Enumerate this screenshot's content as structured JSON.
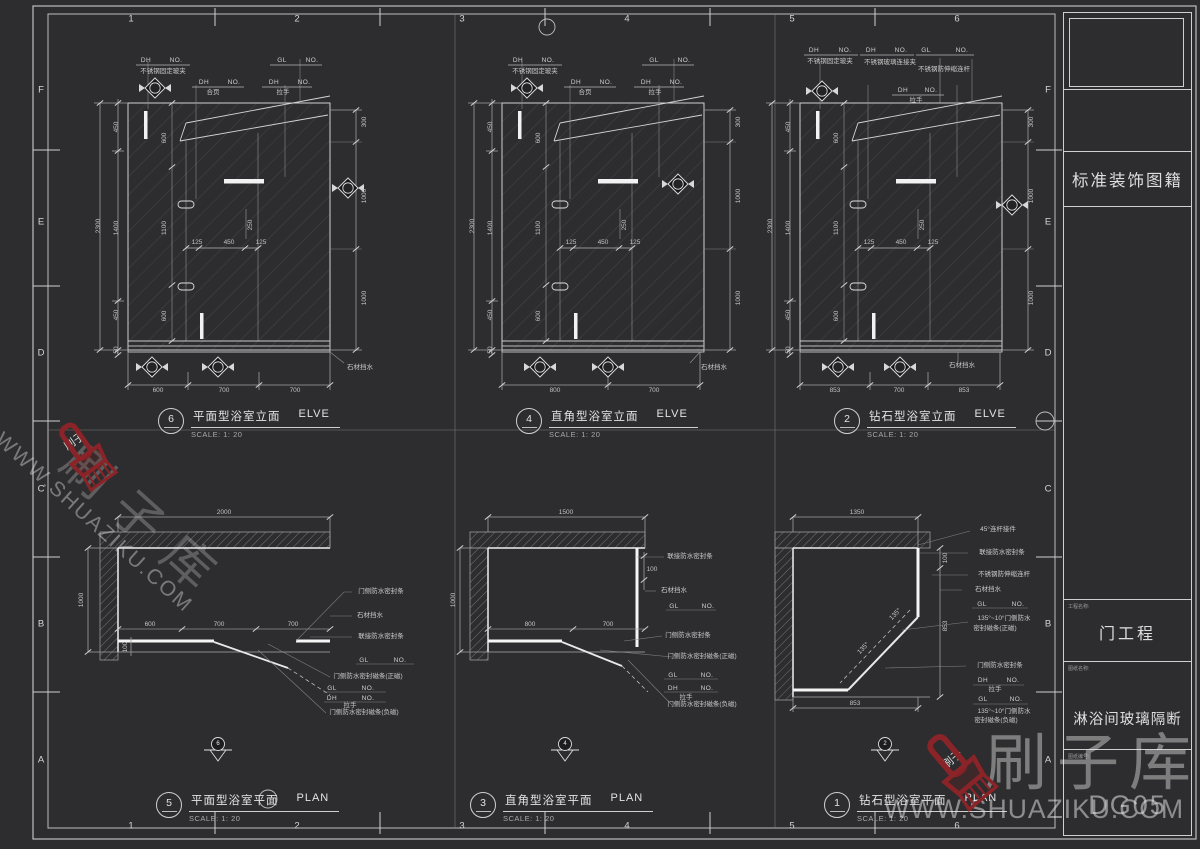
{
  "accent_red": "#8A2428",
  "line_color": "#C9C9C9",
  "grid": {
    "top_numbers": [
      "1",
      "2",
      "3",
      "4",
      "5",
      "6"
    ],
    "bottom_numbers": [
      "1",
      "2",
      "3",
      "4",
      "5",
      "6"
    ],
    "left_letters": [
      "F",
      "E",
      "D",
      "C",
      "B",
      "A"
    ],
    "right_letters": [
      "F",
      "E",
      "D",
      "C",
      "B",
      "A"
    ]
  },
  "title_block": {
    "series_title": "标准装饰图籍",
    "project_label": "工程名称:",
    "project_name": "门工程",
    "drawing_label": "图纸名称:",
    "drawing_name": "淋浴间玻璃隔断",
    "number_label": "图纸编号:",
    "drawing_number": "DG05"
  },
  "watermark": {
    "brand": "刷子库",
    "url": "WWW.SHUAZIKU.COM",
    "logo_text": "刷子"
  },
  "drawings": [
    {
      "no": "6",
      "name": "平面型浴室立面",
      "kind": "ELVE",
      "scale": "SCALE: 1: 20"
    },
    {
      "no": "4",
      "name": "直角型浴室立面",
      "kind": "ELVE",
      "scale": "SCALE: 1: 20"
    },
    {
      "no": "2",
      "name": "钻石型浴室立面",
      "kind": "ELVE",
      "scale": "SCALE: 1: 20"
    },
    {
      "no": "5",
      "name": "平面型浴室平面",
      "kind": "PLAN",
      "scale": "SCALE: 1: 20"
    },
    {
      "no": "3",
      "name": "直角型浴室平面",
      "kind": "PLAN",
      "scale": "SCALE: 1: 20"
    },
    {
      "no": "1",
      "name": "钻石型浴室平面",
      "kind": "PLAN",
      "scale": "SCALE: 1: 20"
    }
  ],
  "labels": [
    [
      "1",
      131,
      19,
      0,
      "g"
    ],
    [
      "2",
      297,
      19,
      0,
      "g"
    ],
    [
      "3",
      462,
      19,
      0,
      "g"
    ],
    [
      "4",
      627,
      19,
      0,
      "g"
    ],
    [
      "5",
      792,
      19,
      0,
      "g"
    ],
    [
      "6",
      957,
      19,
      0,
      "g"
    ],
    [
      "1",
      131,
      826,
      0,
      "g"
    ],
    [
      "2",
      297,
      826,
      0,
      "g"
    ],
    [
      "3",
      462,
      826,
      0,
      "g"
    ],
    [
      "4",
      627,
      826,
      0,
      "g"
    ],
    [
      "5",
      792,
      826,
      0,
      "g"
    ],
    [
      "6",
      957,
      826,
      0,
      "g"
    ],
    [
      "F",
      41,
      90,
      0,
      "g"
    ],
    [
      "E",
      41,
      222,
      0,
      "g"
    ],
    [
      "D",
      41,
      353,
      0,
      "g"
    ],
    [
      "C",
      41,
      489,
      0,
      "g"
    ],
    [
      "B",
      41,
      624,
      0,
      "g"
    ],
    [
      "A",
      41,
      760,
      0,
      "g"
    ],
    [
      "F",
      1048,
      90,
      0,
      "g"
    ],
    [
      "E",
      1048,
      222,
      0,
      "g"
    ],
    [
      "D",
      1048,
      353,
      0,
      "g"
    ],
    [
      "C",
      1048,
      489,
      0,
      "g"
    ],
    [
      "B",
      1048,
      624,
      0,
      "g"
    ],
    [
      "A",
      1048,
      760,
      0,
      "g"
    ],
    [
      "DH",
      146,
      61,
      0,
      "c"
    ],
    [
      "NO.",
      176,
      61,
      0,
      "c"
    ],
    [
      "不锈钢固定玻夹",
      163,
      72,
      0,
      "n"
    ],
    [
      "GL",
      282,
      61,
      0,
      "c"
    ],
    [
      "NO.",
      312,
      61,
      0,
      "c"
    ],
    [
      "DH",
      204,
      83,
      0,
      "c"
    ],
    [
      "NO.",
      234,
      83,
      0,
      "c"
    ],
    [
      "合页",
      213,
      93,
      0,
      "n"
    ],
    [
      "DH",
      274,
      83,
      0,
      "c"
    ],
    [
      "NO.",
      304,
      83,
      0,
      "c"
    ],
    [
      "拉手",
      283,
      93,
      0,
      "n"
    ],
    [
      "450",
      117,
      127,
      -90,
      "d"
    ],
    [
      "1400",
      117,
      228,
      -90,
      "d"
    ],
    [
      "450",
      117,
      315,
      -90,
      "d"
    ],
    [
      "50",
      117,
      350,
      -90,
      "d"
    ],
    [
      "2300",
      99,
      226,
      -90,
      "d"
    ],
    [
      "600",
      165,
      138,
      -90,
      "d"
    ],
    [
      "1100",
      165,
      228,
      -90,
      "d"
    ],
    [
      "600",
      165,
      316,
      -90,
      "d"
    ],
    [
      "125",
      197,
      243,
      0,
      "d"
    ],
    [
      "450",
      229,
      243,
      0,
      "d"
    ],
    [
      "125",
      261,
      243,
      0,
      "d"
    ],
    [
      "250",
      251,
      225,
      -90,
      "d"
    ],
    [
      "300",
      365,
      122,
      -90,
      "d"
    ],
    [
      "1000",
      365,
      196,
      -90,
      "d"
    ],
    [
      "1000",
      365,
      298,
      -90,
      "d"
    ],
    [
      "600",
      158,
      391,
      0,
      "d"
    ],
    [
      "700",
      224,
      391,
      0,
      "d"
    ],
    [
      "700",
      295,
      391,
      0,
      "d"
    ],
    [
      "石材挡水",
      360,
      368,
      0,
      "n"
    ],
    [
      "DH",
      518,
      61,
      0,
      "c"
    ],
    [
      "NO.",
      548,
      61,
      0,
      "c"
    ],
    [
      "不锈钢固定玻夹",
      535,
      72,
      0,
      "n"
    ],
    [
      "GL",
      654,
      61,
      0,
      "c"
    ],
    [
      "NO.",
      684,
      61,
      0,
      "c"
    ],
    [
      "DH",
      576,
      83,
      0,
      "c"
    ],
    [
      "NO.",
      606,
      83,
      0,
      "c"
    ],
    [
      "合页",
      585,
      93,
      0,
      "n"
    ],
    [
      "DH",
      646,
      83,
      0,
      "c"
    ],
    [
      "NO.",
      676,
      83,
      0,
      "c"
    ],
    [
      "拉手",
      655,
      93,
      0,
      "n"
    ],
    [
      "450",
      491,
      127,
      -90,
      "d"
    ],
    [
      "1400",
      491,
      228,
      -90,
      "d"
    ],
    [
      "450",
      491,
      315,
      -90,
      "d"
    ],
    [
      "50",
      491,
      350,
      -90,
      "d"
    ],
    [
      "2300",
      473,
      226,
      -90,
      "d"
    ],
    [
      "600",
      539,
      138,
      -90,
      "d"
    ],
    [
      "1100",
      539,
      228,
      -90,
      "d"
    ],
    [
      "600",
      539,
      316,
      -90,
      "d"
    ],
    [
      "125",
      571,
      243,
      0,
      "d"
    ],
    [
      "450",
      603,
      243,
      0,
      "d"
    ],
    [
      "125",
      635,
      243,
      0,
      "d"
    ],
    [
      "250",
      625,
      225,
      -90,
      "d"
    ],
    [
      "300",
      739,
      122,
      -90,
      "d"
    ],
    [
      "1000",
      739,
      196,
      -90,
      "d"
    ],
    [
      "1000",
      739,
      298,
      -90,
      "d"
    ],
    [
      "800",
      555,
      391,
      0,
      "d"
    ],
    [
      "700",
      654,
      391,
      0,
      "d"
    ],
    [
      "石材挡水",
      714,
      368,
      0,
      "n"
    ],
    [
      "DH",
      814,
      51,
      0,
      "c"
    ],
    [
      "NO.",
      845,
      51,
      0,
      "c"
    ],
    [
      "不锈钢固定玻夹",
      830,
      62,
      0,
      "n"
    ],
    [
      "DH",
      871,
      51,
      0,
      "c"
    ],
    [
      "NO.",
      901,
      51,
      0,
      "c"
    ],
    [
      "不锈钢玻璃连接夹",
      890,
      63,
      0,
      "n"
    ],
    [
      "GL",
      926,
      51,
      0,
      "c"
    ],
    [
      "NO.",
      962,
      51,
      0,
      "c"
    ],
    [
      "不锈钢防伸缩连杆",
      944,
      70,
      0,
      "n"
    ],
    [
      "DH",
      903,
      91,
      0,
      "c"
    ],
    [
      "NO.",
      931,
      91,
      0,
      "c"
    ],
    [
      "拉手",
      916,
      101,
      0,
      "n"
    ],
    [
      "450",
      789,
      127,
      -90,
      "d"
    ],
    [
      "1400",
      789,
      228,
      -90,
      "d"
    ],
    [
      "450",
      789,
      315,
      -90,
      "d"
    ],
    [
      "50",
      789,
      350,
      -90,
      "d"
    ],
    [
      "2300",
      771,
      226,
      -90,
      "d"
    ],
    [
      "600",
      837,
      138,
      -90,
      "d"
    ],
    [
      "1100",
      837,
      228,
      -90,
      "d"
    ],
    [
      "600",
      837,
      316,
      -90,
      "d"
    ],
    [
      "125",
      869,
      243,
      0,
      "d"
    ],
    [
      "450",
      901,
      243,
      0,
      "d"
    ],
    [
      "125",
      933,
      243,
      0,
      "d"
    ],
    [
      "250",
      923,
      225,
      -90,
      "d"
    ],
    [
      "300",
      1032,
      122,
      -90,
      "d"
    ],
    [
      "1000",
      1032,
      196,
      -90,
      "d"
    ],
    [
      "1000",
      1032,
      298,
      -90,
      "d"
    ],
    [
      "853",
      835,
      391,
      0,
      "d"
    ],
    [
      "700",
      899,
      391,
      0,
      "d"
    ],
    [
      "853",
      964,
      391,
      0,
      "d"
    ],
    [
      "石材挡水",
      962,
      366,
      0,
      "n"
    ],
    [
      "2000",
      224,
      513,
      0,
      "d"
    ],
    [
      "1000",
      82,
      600,
      -90,
      "d"
    ],
    [
      "600",
      150,
      625,
      0,
      "d"
    ],
    [
      "700",
      219,
      625,
      0,
      "d"
    ],
    [
      "700",
      293,
      625,
      0,
      "d"
    ],
    [
      "100",
      126,
      647,
      -90,
      "d"
    ],
    [
      "门侧防水密封条",
      381,
      592,
      0,
      "n"
    ],
    [
      "石材挡水",
      370,
      616,
      0,
      "n"
    ],
    [
      "联接防水密封条",
      381,
      637,
      0,
      "n"
    ],
    [
      "GL",
      364,
      661,
      0,
      "c"
    ],
    [
      "NO.",
      400,
      661,
      0,
      "c"
    ],
    [
      "门侧防水密封磁条(正磁)",
      368,
      677,
      0,
      "n"
    ],
    [
      "GL",
      332,
      689,
      0,
      "c"
    ],
    [
      "NO.",
      368,
      689,
      0,
      "c"
    ],
    [
      "DH",
      332,
      699,
      0,
      "c"
    ],
    [
      "NO.",
      368,
      699,
      0,
      "c"
    ],
    [
      "拉手",
      350,
      706,
      0,
      "n"
    ],
    [
      "门侧防水密封磁条(负磁)",
      364,
      713,
      0,
      "n"
    ],
    [
      "6",
      218,
      744,
      0,
      "m"
    ],
    [
      "1500",
      566,
      513,
      0,
      "d"
    ],
    [
      "1000",
      454,
      600,
      -90,
      "d"
    ],
    [
      "800",
      530,
      625,
      0,
      "d"
    ],
    [
      "700",
      608,
      625,
      0,
      "d"
    ],
    [
      "100",
      652,
      570,
      0,
      "d"
    ],
    [
      "联接防水密封条",
      690,
      557,
      0,
      "n"
    ],
    [
      "石材挡水",
      674,
      591,
      0,
      "n"
    ],
    [
      "GL",
      674,
      607,
      0,
      "c"
    ],
    [
      "NO.",
      708,
      607,
      0,
      "c"
    ],
    [
      "门侧防水密封条",
      688,
      636,
      0,
      "n"
    ],
    [
      "门侧防水密封磁条(正磁)",
      702,
      657,
      0,
      "n"
    ],
    [
      "GL",
      673,
      676,
      0,
      "c"
    ],
    [
      "NO.",
      707,
      676,
      0,
      "c"
    ],
    [
      "DH",
      673,
      689,
      0,
      "c"
    ],
    [
      "NO.",
      707,
      689,
      0,
      "c"
    ],
    [
      "拉手",
      686,
      698,
      0,
      "n"
    ],
    [
      "门侧防水密封磁条(负磁)",
      702,
      705,
      0,
      "n"
    ],
    [
      "4",
      565,
      744,
      0,
      "m"
    ],
    [
      "1350",
      857,
      513,
      0,
      "d"
    ],
    [
      "45°连杆接件",
      998,
      530,
      0,
      "n"
    ],
    [
      "联接防水密封条",
      1002,
      553,
      0,
      "n"
    ],
    [
      "不锈钢防伸缩连杆",
      1004,
      575,
      0,
      "n"
    ],
    [
      "石材挡水",
      988,
      590,
      0,
      "n"
    ],
    [
      "GL",
      982,
      605,
      0,
      "c"
    ],
    [
      "NO.",
      1018,
      605,
      0,
      "c"
    ],
    [
      "135°~10°门侧防水",
      1004,
      619,
      0,
      "n"
    ],
    [
      "密封磁条(正磁)",
      995,
      629,
      0,
      "n"
    ],
    [
      "100",
      946,
      558,
      -90,
      "d"
    ],
    [
      "853",
      946,
      626,
      -90,
      "d"
    ],
    [
      "门侧防水密封条",
      1000,
      666,
      0,
      "n"
    ],
    [
      "DH",
      983,
      681,
      0,
      "c"
    ],
    [
      "NO.",
      1013,
      681,
      0,
      "c"
    ],
    [
      "拉手",
      995,
      690,
      0,
      "n"
    ],
    [
      "GL",
      983,
      700,
      0,
      "c"
    ],
    [
      "NO.",
      1016,
      700,
      0,
      "c"
    ],
    [
      "135°~10°门侧防水",
      1004,
      712,
      0,
      "n"
    ],
    [
      "密封磁条(负磁)",
      996,
      721,
      0,
      "n"
    ],
    [
      "853",
      855,
      704,
      0,
      "d"
    ],
    [
      "135°",
      896,
      615,
      -46,
      "d"
    ],
    [
      "135°",
      864,
      649,
      -46,
      "d"
    ],
    [
      "2",
      885,
      744,
      0,
      "m"
    ],
    [
      "刷子",
      75,
      442,
      -35,
      "w"
    ],
    [
      "刷子",
      953,
      760,
      -40,
      "w"
    ]
  ]
}
